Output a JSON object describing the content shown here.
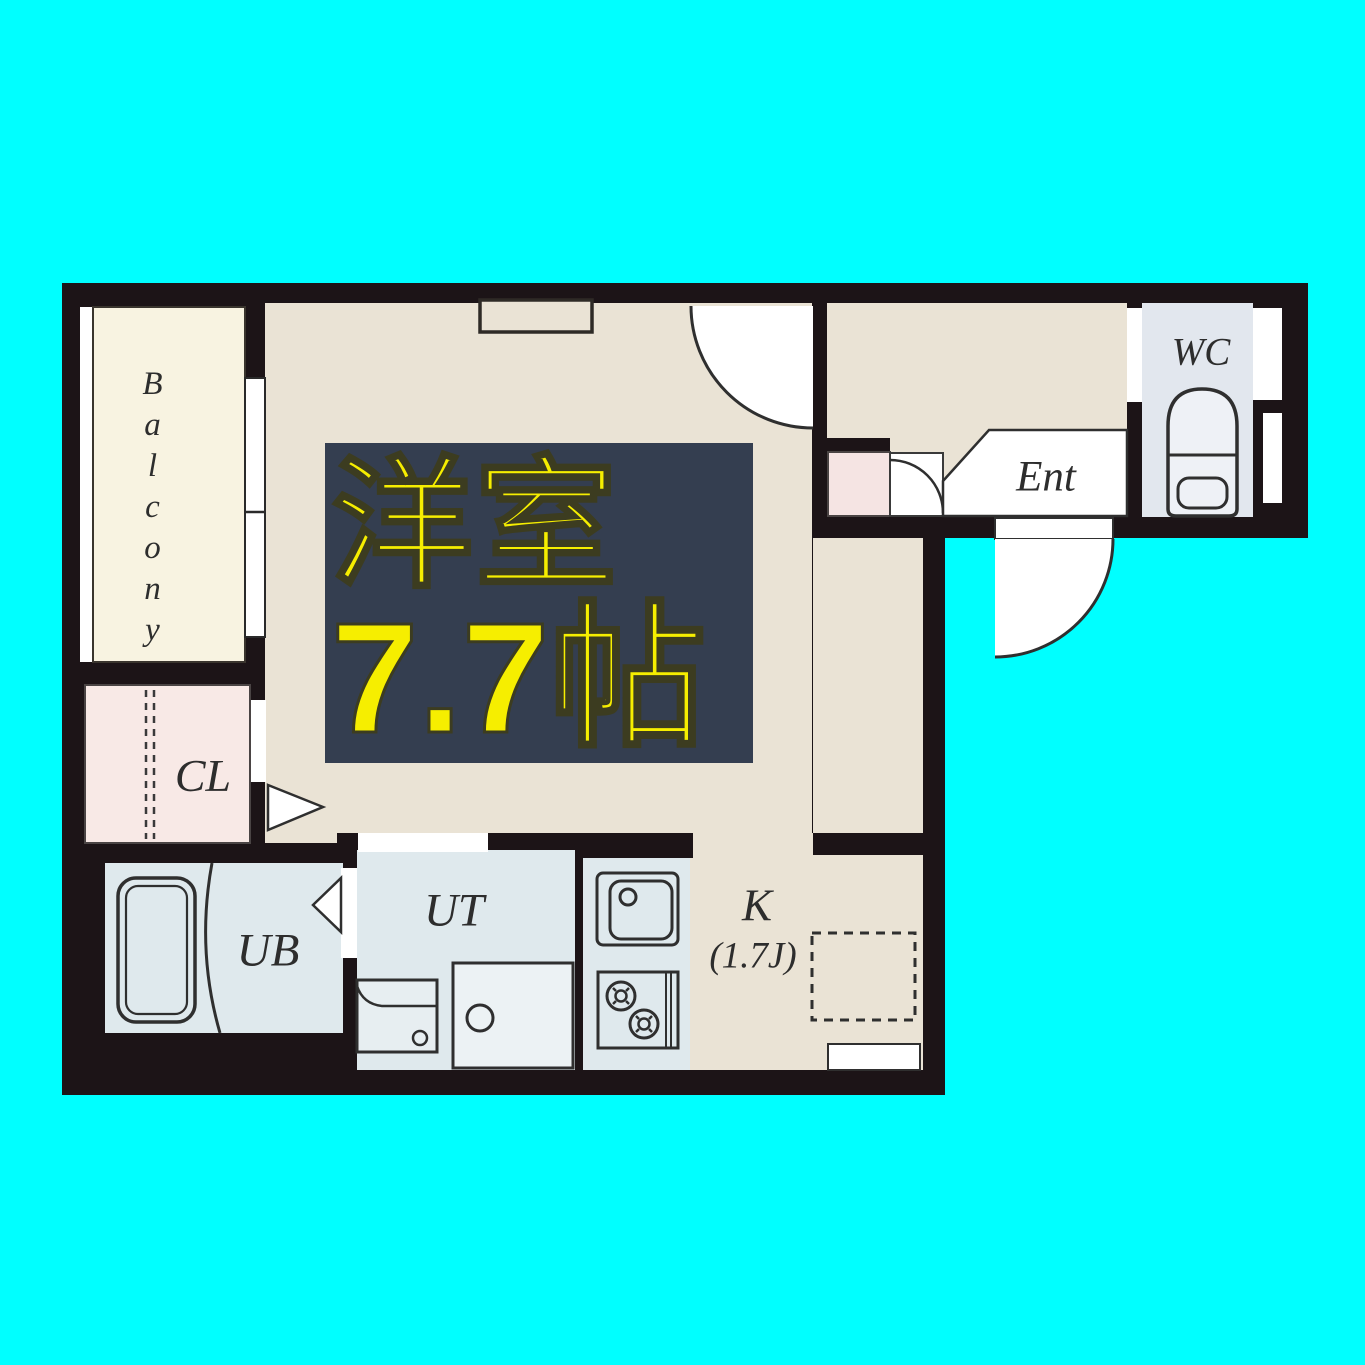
{
  "background_color": "#00ffff",
  "floor_plan": {
    "badge": {
      "room_name": "洋室",
      "room_size": "7.7帖",
      "background": "#343e50",
      "text_color": "#f6ee00"
    },
    "labels": {
      "balcony": "Balcony",
      "closet": "CL",
      "unit_bath": "UB",
      "utility": "UT",
      "kitchen": "K",
      "kitchen_size": "(1.7J)",
      "entrance": "Ent",
      "toilet": "WC"
    },
    "colors": {
      "wall": "#1c1417",
      "main_room_floor": "#eae3d5",
      "balcony_floor": "#f8f3e1",
      "closet_floor": "#f8e9e6",
      "wet_area_floor": "#dfe9ed",
      "toilet_floor": "#e2e7ee",
      "entrance_step_pink": "#f5e4e3",
      "door_white": "#ffffff",
      "fixture_line": "#2f2f2f"
    }
  }
}
